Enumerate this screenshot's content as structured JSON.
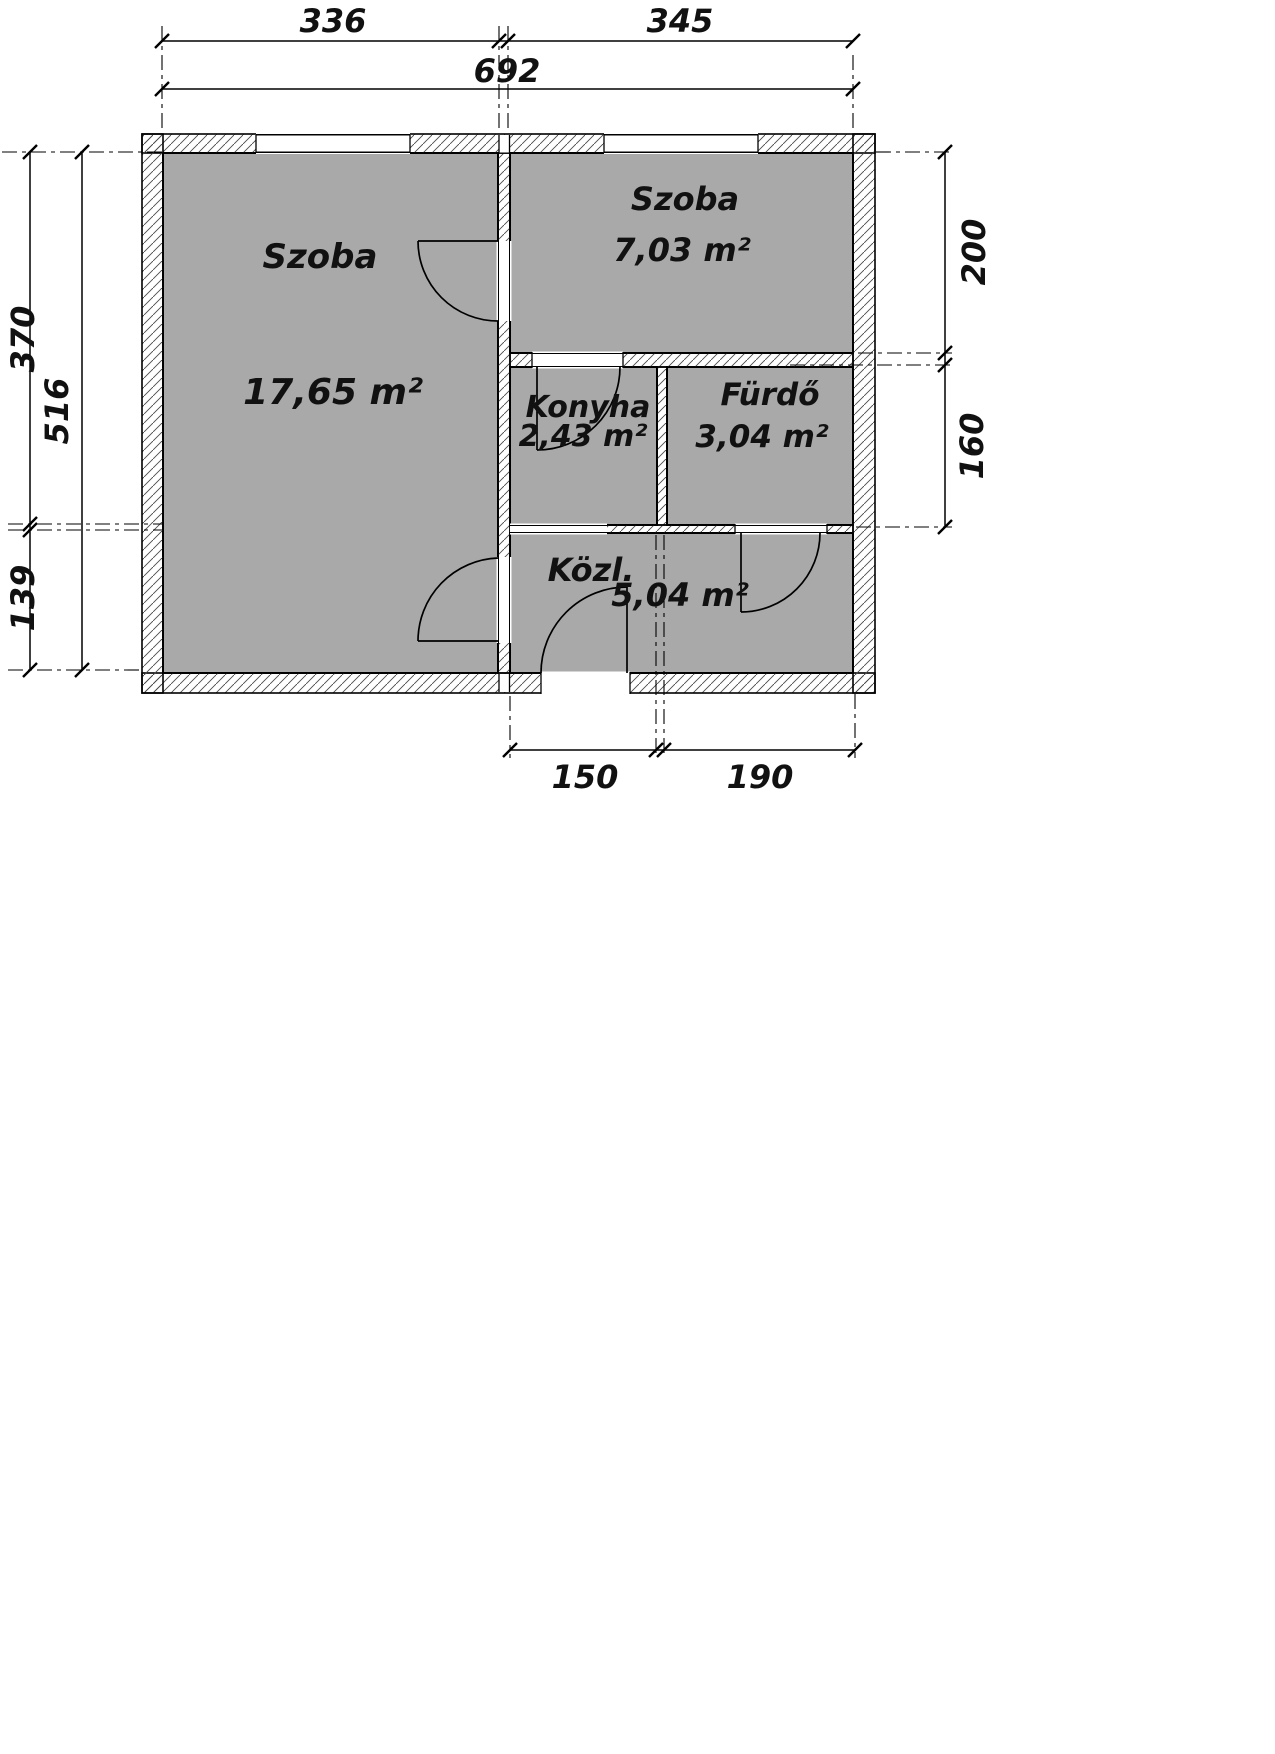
{
  "drawing": {
    "type": "apartment floor plan"
  },
  "rooms": [
    {
      "name": "szoba-large",
      "label": "Szoba",
      "area": "17,65 m²"
    },
    {
      "name": "szoba-small",
      "label": "Szoba",
      "area": "7,03 m²"
    },
    {
      "name": "konyha",
      "label": "Konyha",
      "area": "2,43 m²"
    },
    {
      "name": "furdo",
      "label": "Fürdő",
      "area": "3,04 m²"
    },
    {
      "name": "kozl",
      "label": "Közl.",
      "area": "5,04 m²"
    }
  ],
  "dims": {
    "top": [
      "336",
      "345",
      "692"
    ],
    "left": [
      "370",
      "516",
      "139"
    ],
    "right": [
      "200",
      "160"
    ],
    "bottom": [
      "150",
      "190"
    ]
  },
  "colors": {
    "floor": "#a9a9a9",
    "wall_hatch": "#4a4a4a",
    "line": "#000000",
    "background": "#ffffff"
  }
}
